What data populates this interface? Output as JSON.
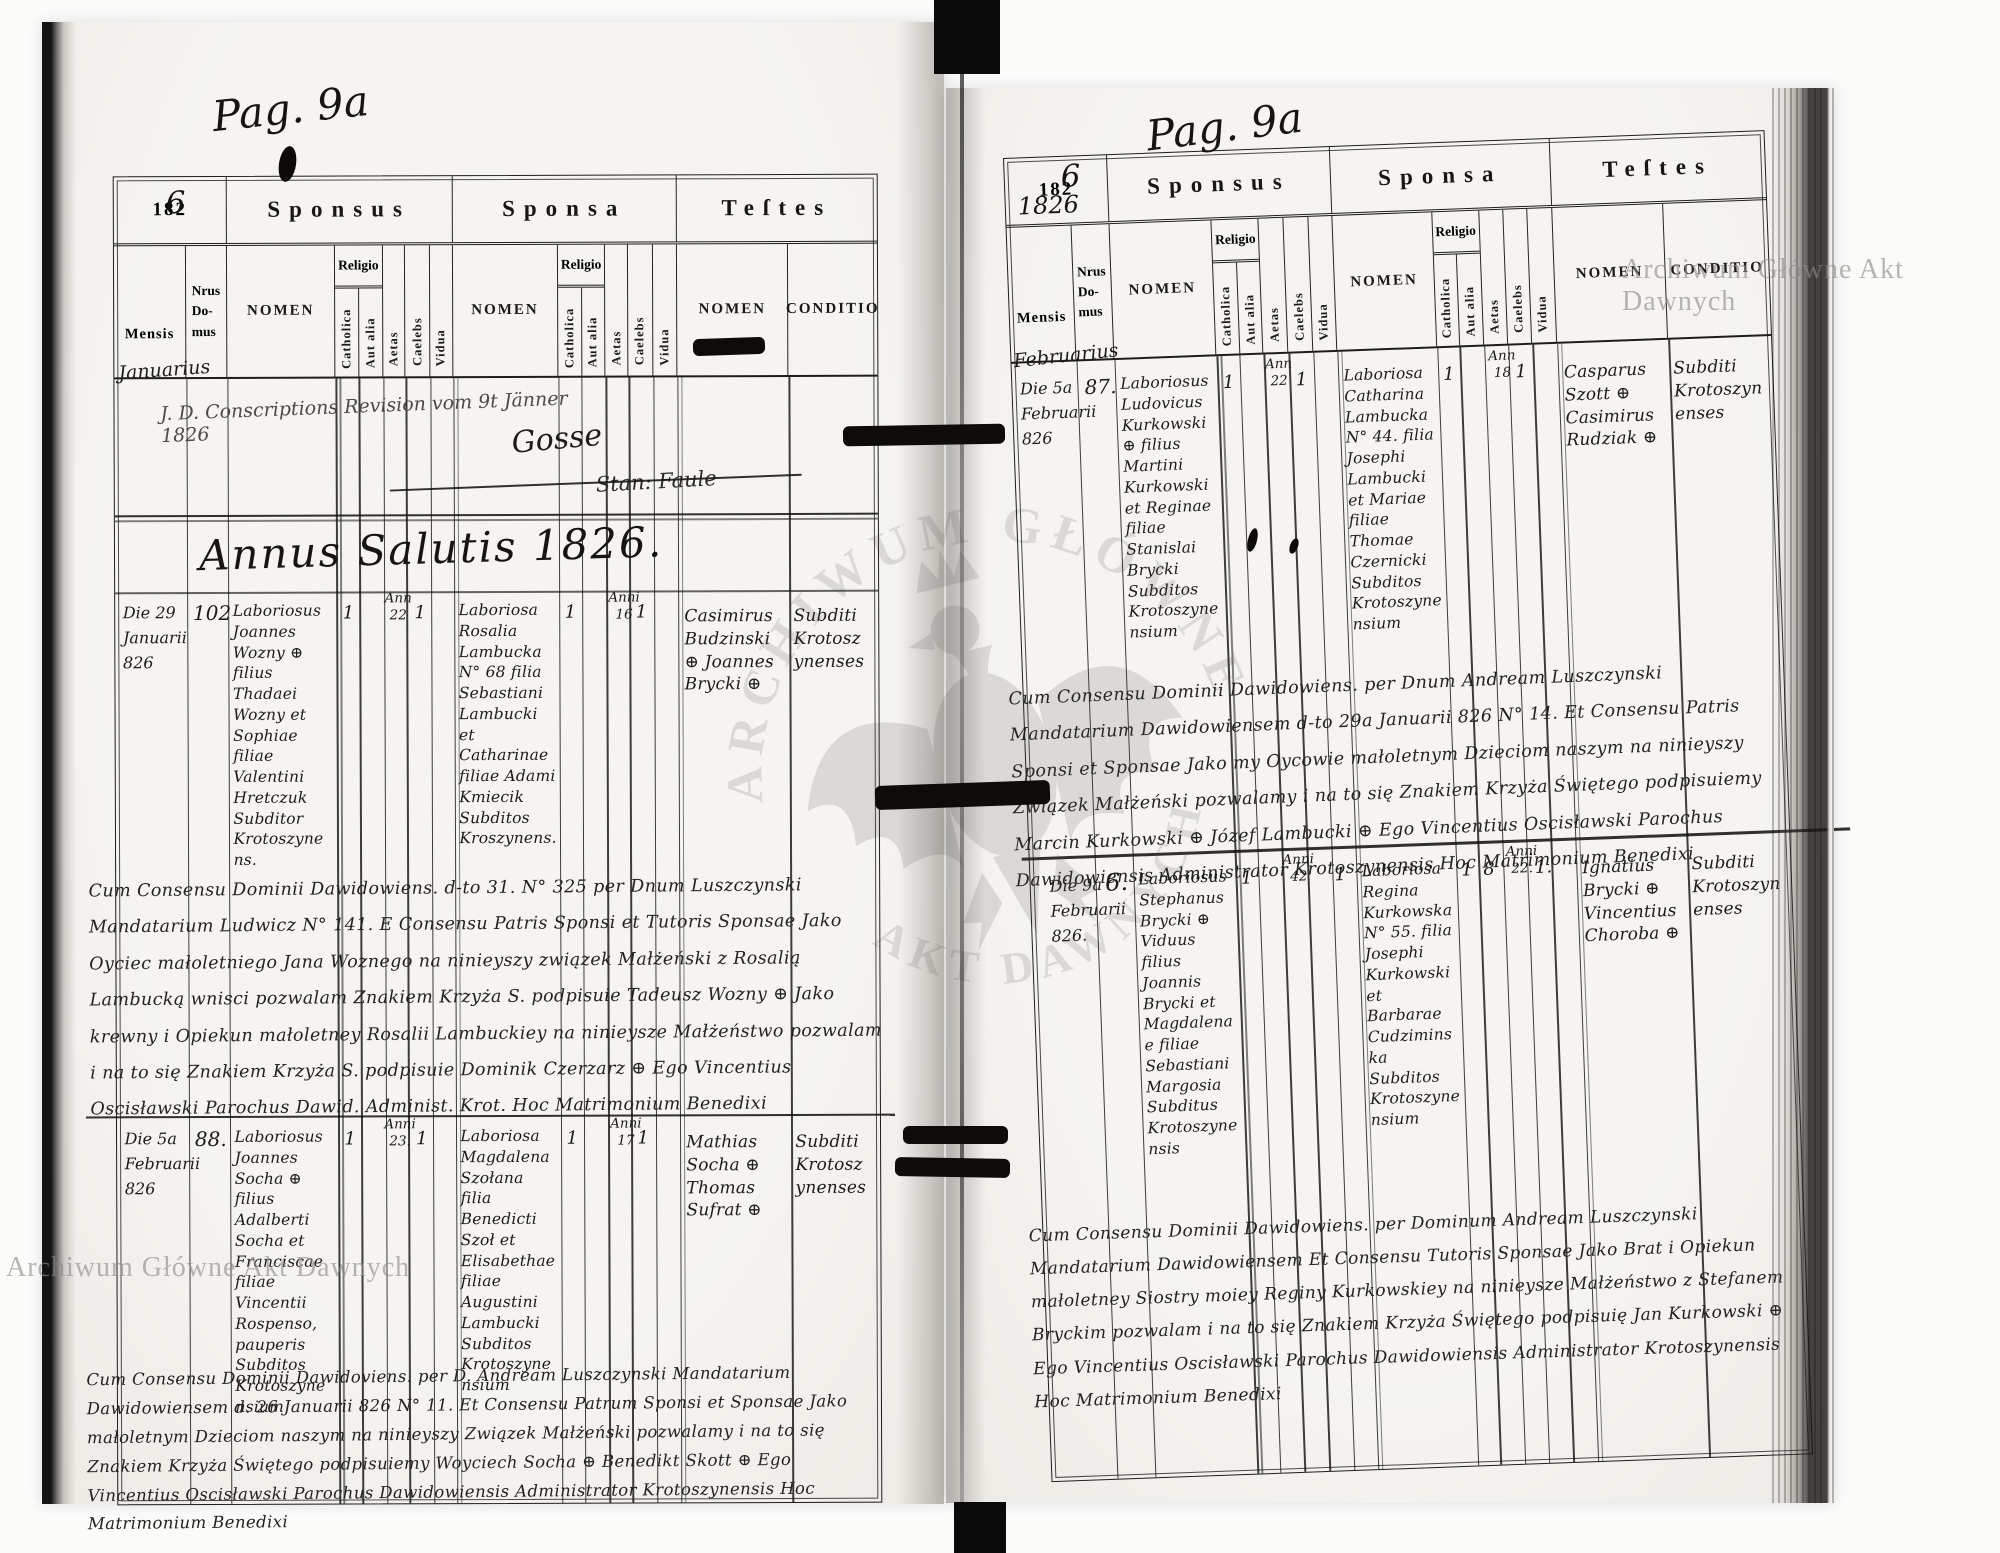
{
  "watermark": {
    "corner_text": "Archiwum Główne Akt Dawnych",
    "arc_top": "ARCHIWUM GŁÓWNE",
    "arc_bottom": "AKT DAWNYCH"
  },
  "headers": {
    "year_printed": "182",
    "sponsus": "Sponsus",
    "sponsa": "Sponsa",
    "testes": "Teſtes",
    "mensis": "Mensis",
    "nrus_line1": "Nrus",
    "nrus_line2": "Do-",
    "nrus_line3": "mus",
    "nomen": "NOMEN",
    "religio": "Religio",
    "catholica": "Catholica",
    "aut_alia": "Aut alia",
    "aetas": "Aetas",
    "caelebs": "Caelebs",
    "vidua": "Vidua",
    "conditio": "CONDITIO"
  },
  "left_page": {
    "page_no_hand": "Pag. 9a",
    "year_digit_hand": "6",
    "month_hand": "Januarius",
    "revision_note": "J. D. Conscriptions Revision vom 9t Jänner 1826",
    "revision_sig1": "Gosse",
    "revision_sig2": "Stan: Faule",
    "annus_line": "Annus Salutis 1826.",
    "entries": [
      {
        "mensis": "Die 29 Januarii 826",
        "nrus": "102",
        "sponsus_nomen": "Laboriosus Joannes Wozny ⊕ filius Thadaei Wozny et Sophiae filiae Valentini Hretczuk Subditor Krotoszynens.",
        "sponsus_catholica": "1",
        "sponsus_aetas": "Ann 22",
        "sponsus_caelebs": "1",
        "sponsa_nomen": "Laboriosa Rosalia Lambucka N° 68 filia Sebastiani Lambucki et Catharinae filiae Adami Kmiecik Subditos Kroszynens.",
        "sponsa_catholica": "1",
        "sponsa_aetas": "Anni 16",
        "sponsa_caelebs": "1",
        "testes_nomen": "Casimirus Budzinski ⊕ Joannes Brycki ⊕",
        "testes_conditio": "Subditi Krotoszynenses"
      },
      {
        "mensis": "Die 5a Februarii 826",
        "nrus": "88.",
        "sponsus_nomen": "Laboriosus Joannes Socha ⊕ filius Adalberti Socha et Franciscae filiae Vincentii Rospenso, pauperis Subditos Krotoszynensium",
        "sponsus_catholica": "1",
        "sponsus_aetas": "Anni 23.",
        "sponsus_caelebs": "1",
        "sponsa_nomen": "Laboriosa Magdalena Szołana filia Benedicti Szoł et Elisabethae filiae Augustini Lambucki Subditos Krotoszynensium",
        "sponsa_catholica": "1",
        "sponsa_aetas": "Anni 17",
        "sponsa_caelebs": "1",
        "testes_nomen": "Mathias Socha ⊕ Thomas Sufrat ⊕",
        "testes_conditio": "Subditi Krotoszynenses"
      }
    ],
    "notes": [
      "Cum Consensu Dominii Dawidowiens. d-to 31. N° 325 per Dnum Luszczynski Mandatarium Ludwicz N° 141. E Consensu Patris Sponsi et Tutoris Sponsae Jako Oyciec małoletniego Jana Woznego na ninieyszy związek Małżeński z Rosalią Lambucką wnisci pozwalam Znakiem Krzyża S. podpisuie Tadeusz Wozny ⊕ Jako krewny i Opiekun małoletney Rosalii Lambuckiey na ninieysze Małżeństwo pozwalam i na to się Znakiem Krzyża S. podpisuie Dominik Czerzarz ⊕ Ego Vincentius Oscisławski Parochus Dawid. Administ. Krot. Hoc Matrimonium Benedixi",
      "Cum Consensu Dominii Dawidoviens. per D. Andream Luszczynski Mandatarium Dawidowiensem d. 26 Januarii 826 N° 11. Et Consensu Patrum Sponsi et Sponsae Jako małoletnym Dzieciom naszym na ninieyszy Związek Małżeński pozwalamy i na to się Znakiem Krzyża Świętego podpisuiemy Woyciech Socha ⊕ Benedikt Skott ⊕ Ego Vincentius Oscisławski Parochus Dawidowiensis Administrator Krotoszynensis Hoc Matrimonium Benedixi"
    ]
  },
  "right_page": {
    "page_no_hand": "Pag. 9a",
    "year_digit_hand": "6",
    "year_hand": "1826",
    "month_hand": "Februarius",
    "entries": [
      {
        "mensis": "Die 5a Februarii 826",
        "nrus": "87.",
        "sponsus_nomen": "Laboriosus Ludovicus Kurkowski ⊕ filius Martini Kurkowski et Reginae filiae Stanislai Brycki Subditos Krotoszynensium",
        "sponsus_catholica": "1",
        "sponsus_aetas": "Ann 22",
        "sponsus_caelebs": "1",
        "sponsa_nomen": "Laboriosa Catharina Lambucka N° 44. filia Josephi Lambucki et Mariae filiae Thomae Czernicki Subditos Krotoszynensium",
        "sponsa_catholica": "1",
        "sponsa_aetas": "Ann 18",
        "sponsa_caelebs": "1",
        "testes_nomen": "Casparus Szott ⊕ Casimirus Rudziak ⊕",
        "testes_conditio": "Subditi Krotoszynenses"
      },
      {
        "mensis": "Die 9a Februarii 826.",
        "nrus": "6.",
        "sponsus_nomen": "Laboriosus Stephanus Brycki ⊕ Viduus filius Joannis Brycki et Magdalenae filiae Sebastiani Margosia Subditus Krotoszynensis",
        "sponsus_catholica": "1",
        "sponsus_aetas": "Anni 42",
        "sponsus_vidua": "1",
        "sponsa_nomen": "Laboriosa Regina Kurkowska N° 55. filia Josephi Kurkowski et Barbarae Cudziminska Subditos Krotoszynensium",
        "sponsa_catholica": "1",
        "sponsa_aut_alia": "8",
        "sponsa_aetas": "Anni 22.",
        "sponsa_caelebs": "1.",
        "testes_nomen": "Ignatius Brycki ⊕ Vincentius Choroba ⊕",
        "testes_conditio": "Subditi Krotoszynenses"
      }
    ],
    "notes": [
      "Cum Consensu Dominii Dawidowiens. per Dnum Andream Luszczynski Mandatarium Dawidowiensem d-to 29a Januarii 826 N° 14. Et Consensu Patris Sponsi et Sponsae Jako my Oycowie małoletnym Dzieciom naszym na ninieyszy Związek Małżeński pozwalamy i na to się Znakiem Krzyża Świętego podpisuiemy Marcin Kurkowski ⊕ Józef Lambucki ⊕ Ego Vincentius Oscisławski Parochus Dawidowiensis Administrator Krotoszynensis Hoc Matrimonium Benedixi",
      "Cum Consensu Dominii Dawidowiens. per Dominum Andream Luszczynski Mandatarium Dawidowiensem Et Consensu Tutoris Sponsae Jako Brat i Opiekun małoletney Siostry moiey Reginy Kurkowskiey na ninieysze Małżeństwo z Stefanem Bryckim pozwalam i na to się Znakiem Krzyża Świętego podpisuię Jan Kurkowski ⊕ Ego Vincentius Oscisławski Parochus Dawidowiensis Administrator Krotoszynensis Hoc Matrimonium Benedixi"
    ]
  }
}
